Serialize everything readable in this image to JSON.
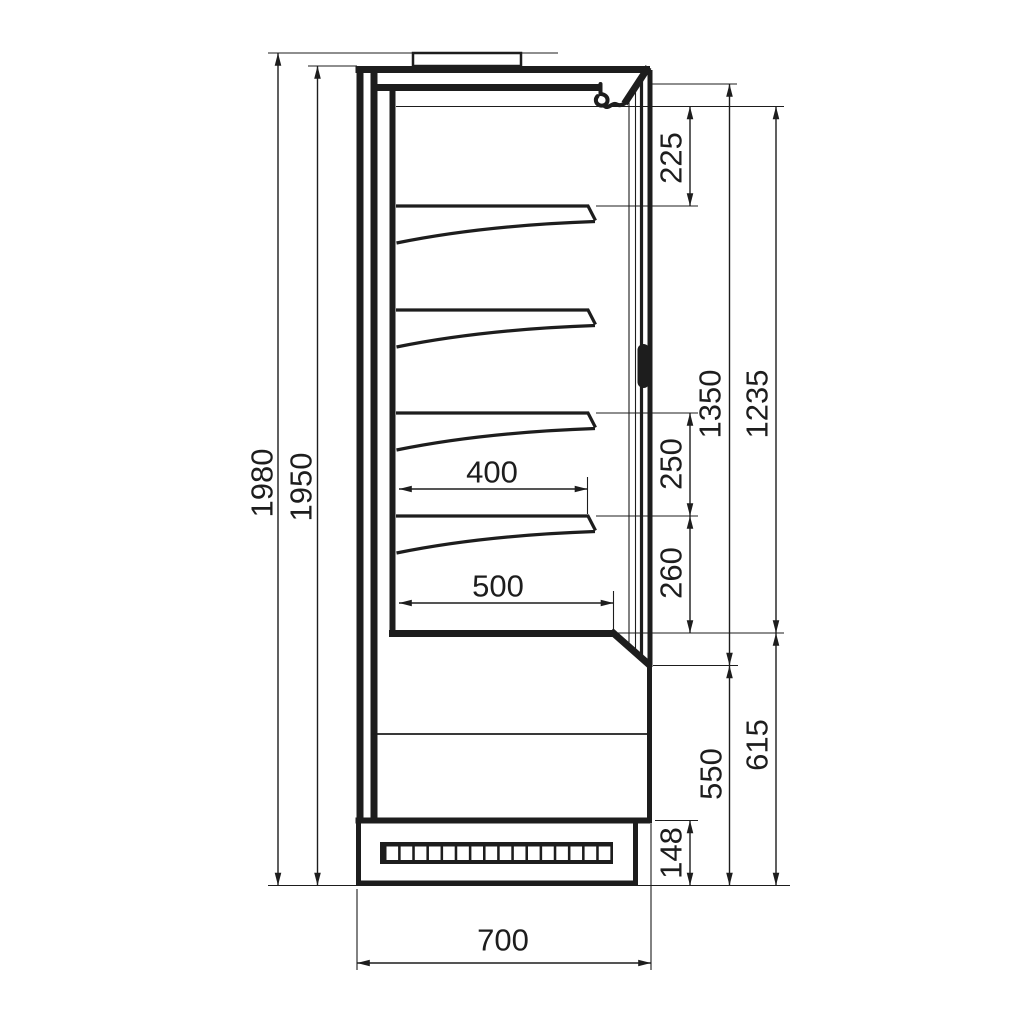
{
  "drawing": {
    "background": "#ffffff",
    "line_color": "#1d1d1d"
  },
  "dimensions": {
    "overall_height": "1980",
    "body_height": "1950",
    "canopy_to_first_shelf": "225",
    "opening_height": "1350",
    "door_glass_height": "1235",
    "shelf_pitch_upper": "250",
    "shelf_pitch_lower": "260",
    "shelf_depth_upper": "400",
    "shelf_depth_bottom": "500",
    "base_front_height": "550",
    "base_total_height": "615",
    "plinth_height": "148",
    "overall_depth": "700"
  }
}
